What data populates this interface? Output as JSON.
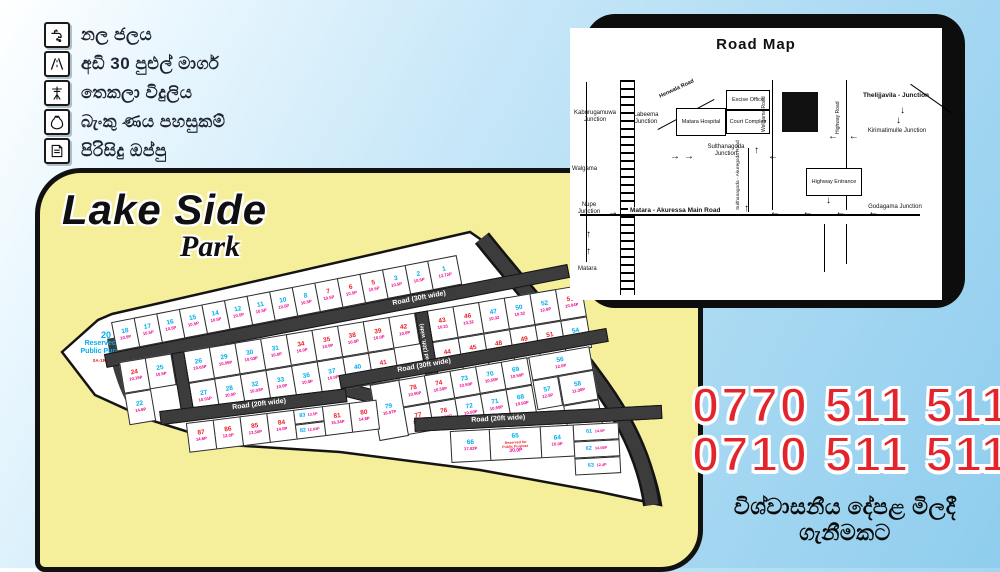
{
  "features": {
    "items": [
      {
        "icon": "tap-icon",
        "label": "නල ජලය"
      },
      {
        "icon": "road-icon",
        "label": "අඩි 30 පුළුල් මාර්ග"
      },
      {
        "icon": "electricity-icon",
        "label": "තෙකලා විදුලිය"
      },
      {
        "icon": "bank-loan-icon",
        "label": "බැංකු ණය පහසුකම්"
      },
      {
        "icon": "deed-icon",
        "label": "පිරිසිදු ඔප්පු"
      }
    ]
  },
  "logo": {
    "line1": "Lake Side",
    "line2": "Park"
  },
  "road_map": {
    "title": "Road Map",
    "labels": {
      "kaburugamuwa": "Kaburugamuwa Junction",
      "labeema": "Labeema Junction",
      "henwala": "Henwala Road",
      "hospital": "Matara Hospital",
      "excise": "Excise Office",
      "court": "Court Complex",
      "weligama_rd": "Weligama Road",
      "sulthanagoda_j": "Sulthanagoda Junction",
      "highway_rd": "Highway Road",
      "thelijjavila": "Thelijjavila - Junction",
      "kirimatimulle": "Kirimatimulle Junction",
      "walgama": "Walgama",
      "nupe": "Nupe Junction",
      "main_road": "Matara - Akuressa Main Road",
      "sul_akur": "Sulthanagoda - Akuregoda Road",
      "hw_entrance": "Highway Entrance",
      "godagama": "Godagama Junction",
      "matara": "Matara"
    }
  },
  "icons": {
    "arrow_right": "→",
    "arrow_left": "←",
    "arrow_up": "↑",
    "arrow_down": "↓",
    "arrow_left_row": "←   ←   ←   ←",
    "arrow_left_pair": "← ←"
  },
  "plot_map": {
    "road_labels": {
      "r30": "Road (30ft wide)",
      "r30v": "Road (30ft. wide)",
      "r20": "Road (20ft wide)",
      "rda": "Road (RDA)"
    },
    "reserved20": {
      "n": "20",
      "line1": "Reserved for",
      "line2": "Public Purpose",
      "sub": "0A-1R-22.9P"
    },
    "reserved65": {
      "n": "65",
      "line1": "Reserved for",
      "line2": "Public Purpose",
      "v": "30.0P"
    },
    "rows": {
      "top": [
        {
          "n": "18",
          "v": "10.5P"
        },
        {
          "n": "17",
          "v": "10.5P"
        },
        {
          "n": "16",
          "v": "10.5P"
        },
        {
          "n": "15",
          "v": "10.5P"
        },
        {
          "n": "14",
          "v": "10.5P"
        },
        {
          "n": "12",
          "v": "10.5P"
        },
        {
          "n": "11",
          "v": "10.5P"
        },
        {
          "n": "10",
          "v": "10.5P"
        },
        {
          "n": "8",
          "v": "10.5P"
        },
        {
          "n": "7",
          "v": "10.5P",
          "c": "r"
        },
        {
          "n": "6",
          "v": "10.5P",
          "c": "r"
        },
        {
          "n": "5",
          "v": "10.5P",
          "c": "r"
        },
        {
          "n": "3",
          "v": "10.5P"
        },
        {
          "n": "2",
          "v": "10.5P"
        },
        {
          "n": "1",
          "v": "13.72P",
          "w": 30
        }
      ],
      "left_top": [
        {
          "n": "24",
          "v": "10.15P",
          "c": "r"
        },
        {
          "n": "25",
          "v": "10.5P"
        }
      ],
      "left_bottom": [
        {
          "n": "22",
          "v": "14.6P"
        }
      ],
      "mid_top": [
        {
          "n": "26",
          "v": "10.03P"
        },
        {
          "n": "29",
          "v": "10.05P"
        },
        {
          "n": "30",
          "v": "10.03P"
        },
        {
          "n": "31",
          "v": "10.0P"
        },
        {
          "n": "34",
          "v": "10.0P",
          "c": "r"
        },
        {
          "n": "35",
          "v": "10.0P",
          "c": "r"
        },
        {
          "n": "38",
          "v": "10.0P",
          "c": "r"
        },
        {
          "n": "39",
          "v": "10.0P",
          "c": "r"
        },
        {
          "n": "42",
          "v": "10.0P",
          "c": "r"
        }
      ],
      "mid_bottom": [
        {
          "n": "27",
          "v": "10.01P"
        },
        {
          "n": "28",
          "v": "10.0P"
        },
        {
          "n": "32",
          "v": "10.03P"
        },
        {
          "n": "33",
          "v": "10.0P"
        },
        {
          "n": "36",
          "v": "10.0P"
        },
        {
          "n": "37",
          "v": "10.0P"
        },
        {
          "n": "40",
          "v": "10.0P"
        },
        {
          "n": "41",
          "v": "10.0P",
          "c": "r"
        }
      ],
      "right_top": [
        {
          "n": "43",
          "v": "10.31",
          "c": "r"
        },
        {
          "n": "46",
          "v": "10.32",
          "c": "r"
        },
        {
          "n": "47",
          "v": "10.32"
        },
        {
          "n": "50",
          "v": "10.32"
        },
        {
          "n": "52",
          "v": "12.8P"
        },
        {
          "n": "53",
          "v": "10.04P",
          "c": "r"
        }
      ],
      "right_bottom": [
        {
          "n": "44",
          "v": "10.31",
          "c": "r"
        },
        {
          "n": "45",
          "v": "10.32",
          "c": "r"
        },
        {
          "n": "48",
          "v": "10.32",
          "c": "r"
        },
        {
          "n": "49",
          "v": "10.32",
          "c": "r"
        },
        {
          "n": "51",
          "v": "10.04P",
          "c": "r"
        },
        {
          "n": "54",
          "v": "12.34P"
        }
      ],
      "c_tall": [
        {
          "n": "79",
          "v": "16.07P"
        }
      ],
      "c_top": [
        {
          "n": "78",
          "v": "10.50P",
          "c": "r"
        },
        {
          "n": "74",
          "v": "10.50P",
          "c": "r"
        },
        {
          "n": "73",
          "v": "10.50P"
        },
        {
          "n": "70",
          "v": "10.50P"
        },
        {
          "n": "69",
          "v": "10.50P"
        }
      ],
      "c_bottom": [
        {
          "n": "77",
          "v": "10.15P",
          "c": "r"
        },
        {
          "n": "76",
          "v": "10.50P",
          "c": "r"
        },
        {
          "n": "72",
          "v": "10.50P"
        },
        {
          "n": "71",
          "v": "10.50P"
        },
        {
          "n": "68",
          "v": "10.50P"
        }
      ],
      "c_right": [
        {
          "n": "56",
          "v": "12.0P"
        },
        {
          "n": "57",
          "v": "12.5P"
        },
        {
          "n": "58",
          "v": "11.30P"
        },
        {
          "n": "59",
          "v": "16.5P"
        }
      ],
      "d_left": [
        {
          "n": "87",
          "v": "14.6P",
          "c": "r"
        },
        {
          "n": "86",
          "v": "12.0P",
          "c": "r"
        },
        {
          "n": "85",
          "v": "13.50P",
          "c": "r"
        },
        {
          "n": "84",
          "v": "14.0P",
          "c": "r"
        }
      ],
      "d_stack": [
        {
          "n": "83",
          "v": "13.5P"
        },
        {
          "n": "82",
          "v": "12.63P"
        }
      ],
      "d_mid": [
        {
          "n": "81",
          "v": "15.34P",
          "c": "r"
        },
        {
          "n": "80",
          "v": "14.6P",
          "c": "r"
        }
      ],
      "d_66": [
        {
          "n": "66",
          "v": "17.02P"
        }
      ],
      "d_64": [
        {
          "n": "64",
          "v": "10.0P"
        }
      ],
      "d_stack2": [
        {
          "n": "61",
          "v": "14.0P"
        },
        {
          "n": "62",
          "v": "14.05P"
        },
        {
          "n": "63",
          "v": "12.4P"
        }
      ]
    }
  },
  "contact": {
    "phone1": "0770 511 511",
    "phone2": "0710 511 511",
    "tagline": "විශ්වාසනීය දේපළ මිලදී ගැනීමකට"
  },
  "colors": {
    "accent_red": "#e3242b",
    "number_cyan": "#00aeef",
    "value_pink": "#ec008c",
    "sold_red": "#e8232a",
    "panel_yellow": "#f5ef9b",
    "road_dark": "#3c3c3c",
    "sky_blue": "#a9d9f2"
  }
}
